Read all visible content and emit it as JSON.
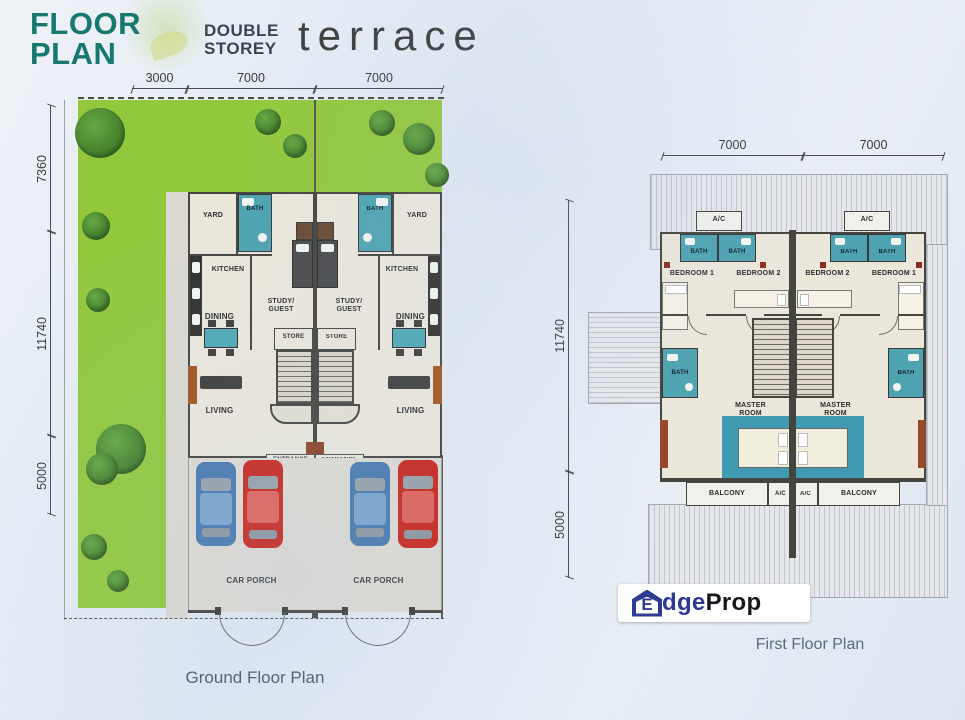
{
  "header": {
    "logo_top": "FLOOR",
    "logo_bottom": "PLAN",
    "type_line1": "DOUBLE",
    "type_line2": "STOREY",
    "type_main": "terrace"
  },
  "ground_floor": {
    "caption": "Ground Floor Plan",
    "dims_top": [
      "3000",
      "7000",
      "7000"
    ],
    "dims_left": [
      "7360",
      "11740",
      "5000"
    ],
    "rooms": {
      "yard": "YARD",
      "bath": "BATH",
      "kitchen": "KITCHEN",
      "study_guest": "STUDY/\nGUEST",
      "dining": "DINING",
      "store": "STORE",
      "living": "LIVING",
      "entrance": "ENTRANCE",
      "car_porch": "CAR PORCH"
    }
  },
  "first_floor": {
    "caption": "First Floor Plan",
    "dims_top": [
      "7000",
      "7000"
    ],
    "dims_left": [
      "11740",
      "5000"
    ],
    "rooms": {
      "ac": "A/C",
      "bath": "BATH",
      "bedroom1": "BEDROOM 1",
      "bedroom2": "BEDROOM 2",
      "master": "MASTER\nROOM",
      "balcony": "BALCONY"
    }
  },
  "watermark": {
    "house_letter": "E",
    "brand_blue": "dge",
    "brand_dark": "Prop"
  },
  "colors": {
    "logo_teal": "#16786f",
    "lawn_green": "#93c83d",
    "bath_teal": "#4fa3b1",
    "floor_beige": "#ece7db",
    "wall_dark": "#45453f",
    "car_blue": "#4879ad",
    "car_red": "#c9261d"
  }
}
